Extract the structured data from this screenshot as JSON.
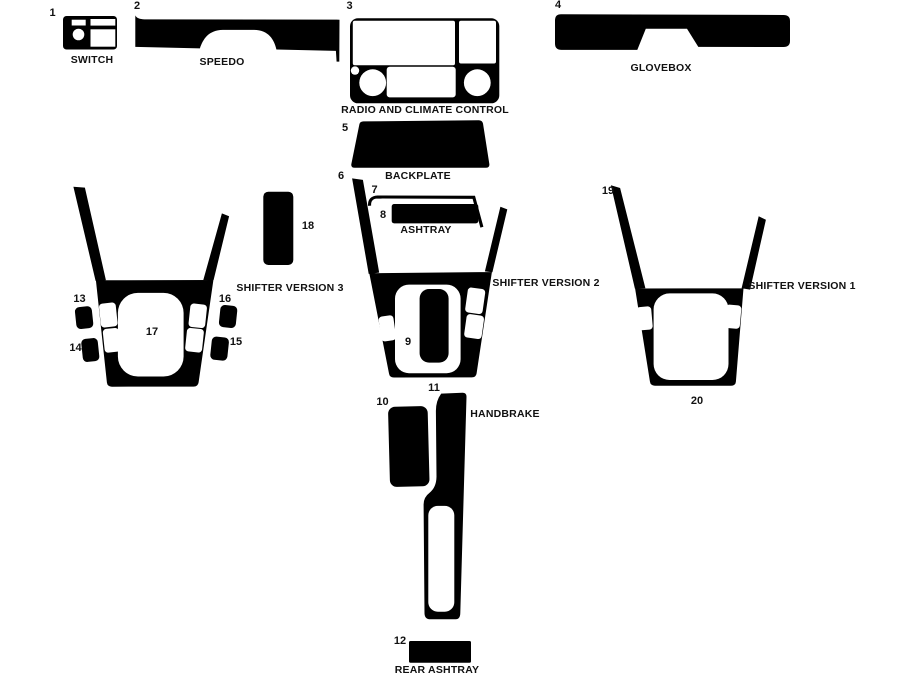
{
  "colors": {
    "background": "#ffffff",
    "parts": "#000000",
    "labels": "#111111"
  },
  "parts": [
    {
      "id": 1,
      "label": "1",
      "caption": "SWITCH"
    },
    {
      "id": 2,
      "label": "2",
      "caption": "SPEEDO"
    },
    {
      "id": 3,
      "label": "3",
      "caption": "RADIO AND CLIMATE CONTROL"
    },
    {
      "id": 4,
      "label": "4",
      "caption": "GLOVEBOX"
    },
    {
      "id": 5,
      "label": "5",
      "caption": "BACKPLATE"
    },
    {
      "id": 6,
      "label": "6",
      "caption": ""
    },
    {
      "id": 7,
      "label": "7",
      "caption": ""
    },
    {
      "id": 8,
      "label": "8",
      "caption": "ASHTRAY"
    },
    {
      "id": 9,
      "label": "9",
      "caption": ""
    },
    {
      "id": 10,
      "label": "10",
      "caption": ""
    },
    {
      "id": 11,
      "label": "11",
      "caption": "HANDBRAKE"
    },
    {
      "id": 12,
      "label": "12",
      "caption": "REAR ASHTRAY"
    },
    {
      "id": 13,
      "label": "13",
      "caption": ""
    },
    {
      "id": 14,
      "label": "14",
      "caption": ""
    },
    {
      "id": 15,
      "label": "15",
      "caption": ""
    },
    {
      "id": 16,
      "label": "16",
      "caption": ""
    },
    {
      "id": 17,
      "label": "17",
      "caption": ""
    },
    {
      "id": 18,
      "label": "18",
      "caption": ""
    },
    {
      "id": 19,
      "label": "19",
      "caption": ""
    },
    {
      "id": 20,
      "label": "20",
      "caption": ""
    }
  ],
  "group_captions": {
    "shifter_version_1": "SHIFTER VERSION 1",
    "shifter_version_2": "SHIFTER VERSION 2",
    "shifter_version_3": "SHIFTER VERSION 3"
  }
}
